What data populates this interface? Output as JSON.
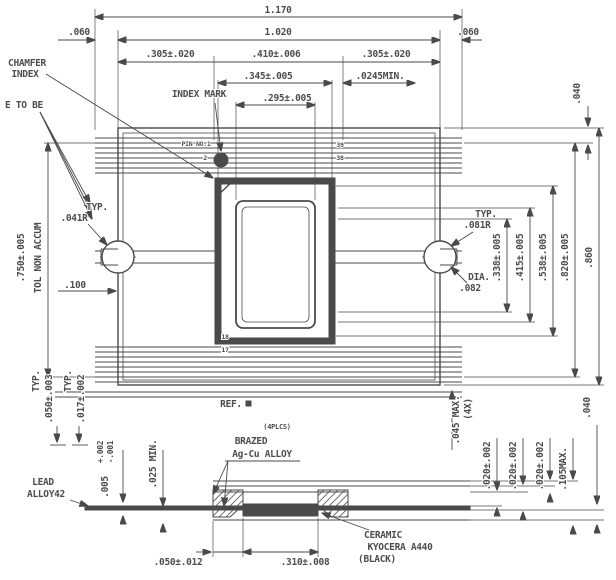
{
  "drawing": {
    "kind": "package outline drawing",
    "colors": {
      "line": "#4a4a4a",
      "ink": "#4d4d4d",
      "background": "#ffffff",
      "ceramic_fill": "#4a4a4a"
    }
  },
  "labels": [
    {
      "name": "dim-overall-width",
      "region": "top-dims",
      "text": "1.170",
      "x": 278,
      "y": 13
    },
    {
      "name": "dim-margin-left",
      "region": "top-dims",
      "text": ".060",
      "x": 79,
      "y": 35
    },
    {
      "name": "dim-body-width",
      "region": "top-dims",
      "text": "1.020",
      "x": 278,
      "y": 35
    },
    {
      "name": "dim-margin-right",
      "region": "top-dims",
      "text": ".060",
      "x": 468,
      "y": 35
    },
    {
      "name": "dim-lead-zone-left",
      "region": "top-dims",
      "text": ".305±.020",
      "x": 170,
      "y": 57
    },
    {
      "name": "dim-center-zone",
      "region": "top-dims",
      "text": ".410±.006",
      "x": 276,
      "y": 57
    },
    {
      "name": "dim-lead-zone-right",
      "region": "top-dims",
      "text": ".305±.020",
      "x": 386,
      "y": 57
    },
    {
      "name": "dim-cavity-outer-width",
      "region": "top-dims",
      "text": ".345±.005",
      "x": 268,
      "y": 79
    },
    {
      "name": "dim-min-clearance",
      "region": "top-dims",
      "text": ".0245MIN.",
      "x": 380,
      "y": 79
    },
    {
      "name": "dim-cavity-inner-width",
      "region": "top-dims",
      "text": ".295±.005",
      "x": 287,
      "y": 101
    },
    {
      "name": "callout-chamfer",
      "region": "left-callouts",
      "text": "CHAMFER",
      "x": 27,
      "y": 66
    },
    {
      "name": "callout-index",
      "region": "left-callouts",
      "text": "INDEX",
      "x": 25,
      "y": 77
    },
    {
      "name": "callout-e-to-be",
      "region": "left-callouts",
      "text": "E TO BE",
      "x": 24,
      "y": 108
    },
    {
      "name": "callout-index-mark",
      "region": "top-view",
      "text": "INDEX MARK",
      "x": 199,
      "y": 97
    },
    {
      "name": "callout-pin-no1",
      "region": "top-view",
      "text": "PIN NO.1",
      "x": 196,
      "y": 146,
      "size": 6.5
    },
    {
      "name": "pin-number-2",
      "region": "top-view",
      "text": "2",
      "x": 205,
      "y": 160,
      "size": 6.5
    },
    {
      "name": "pin-number-39",
      "region": "top-view",
      "text": "39",
      "x": 340,
      "y": 147,
      "size": 6.5
    },
    {
      "name": "pin-number-38",
      "region": "top-view",
      "text": "38",
      "x": 340,
      "y": 160,
      "size": 6.5
    },
    {
      "name": "pin-number-18",
      "region": "top-view",
      "text": "18",
      "x": 225,
      "y": 339,
      "size": 6.5
    },
    {
      "name": "pin-number-17",
      "region": "top-view",
      "text": "17",
      "x": 225,
      "y": 352,
      "size": 6.5
    },
    {
      "name": "typ-left",
      "region": "top-view",
      "text": "TYP.",
      "x": 97,
      "y": 210
    },
    {
      "name": "dim-radius-041",
      "region": "top-view",
      "text": ".041R",
      "x": 74,
      "y": 221
    },
    {
      "name": "dim-100",
      "region": "top-view",
      "text": ".100",
      "x": 75,
      "y": 288
    },
    {
      "name": "typ-right",
      "region": "top-view",
      "text": "TYP.",
      "x": 486,
      "y": 217
    },
    {
      "name": "dim-radius-081",
      "region": "top-view",
      "text": ".081R",
      "x": 477,
      "y": 228
    },
    {
      "name": "label-dia",
      "region": "top-view",
      "text": "DIA.",
      "x": 479,
      "y": 280
    },
    {
      "name": "dim-dia-082",
      "region": "top-view",
      "text": ".082",
      "x": 470,
      "y": 291
    },
    {
      "name": "dim-750",
      "region": "left-dims",
      "text": ".750±.005",
      "x": 24,
      "y": 258,
      "rot": true
    },
    {
      "name": "note-tol-non-accum",
      "region": "left-dims",
      "text": "TOL NON ACCUM",
      "x": 41,
      "y": 258,
      "rot": true
    },
    {
      "name": "dim-338",
      "region": "right-dims",
      "text": ".338±.005",
      "x": 500,
      "y": 258,
      "rot": true
    },
    {
      "name": "dim-415",
      "region": "right-dims",
      "text": ".415±.005",
      "x": 523,
      "y": 258,
      "rot": true
    },
    {
      "name": "dim-538",
      "region": "right-dims",
      "text": ".538±.005",
      "x": 546,
      "y": 258,
      "rot": true
    },
    {
      "name": "dim-820",
      "region": "right-dims",
      "text": ".820±.005",
      "x": 568,
      "y": 258,
      "rot": true
    },
    {
      "name": "dim-860",
      "region": "right-dims",
      "text": ".860",
      "x": 592,
      "y": 258,
      "rot": true
    },
    {
      "name": "dim-040-top",
      "region": "right-dims",
      "text": ".040",
      "x": 580,
      "y": 94,
      "rot": true
    },
    {
      "name": "label-ref",
      "region": "section",
      "text": "REF.",
      "x": 231,
      "y": 407
    },
    {
      "name": "note-4plcs",
      "region": "section",
      "text": "(4PLCS)",
      "x": 277,
      "y": 429,
      "size": 7
    },
    {
      "name": "label-brazed",
      "region": "section",
      "text": "BRAZED",
      "x": 251,
      "y": 444
    },
    {
      "name": "label-agcu-alloy",
      "region": "section",
      "text": "Ag-Cu ALLOY",
      "x": 262,
      "y": 457
    },
    {
      "name": "label-lead",
      "region": "section",
      "text": "LEAD",
      "x": 43,
      "y": 485
    },
    {
      "name": "label-alloy42",
      "region": "section",
      "text": "ALLOY42",
      "x": 46,
      "y": 497
    },
    {
      "name": "label-ceramic",
      "region": "section",
      "text": "CERAMIC",
      "x": 383,
      "y": 538
    },
    {
      "name": "label-kyocera-a440",
      "region": "section",
      "text": "KYOCERA A440",
      "x": 400,
      "y": 550
    },
    {
      "name": "label-black",
      "region": "section",
      "text": "(BLACK)",
      "x": 377,
      "y": 562
    },
    {
      "name": "dim-050-012",
      "region": "section",
      "text": ".050±.012",
      "x": 178,
      "y": 565
    },
    {
      "name": "dim-310-008",
      "region": "section",
      "text": ".310±.008",
      "x": 305,
      "y": 565
    },
    {
      "name": "dim-045-max",
      "region": "section",
      "text": ".045 MAX.",
      "x": 459,
      "y": 420,
      "rot": true
    },
    {
      "name": "qty-4x",
      "region": "section",
      "text": "(4X)",
      "x": 471,
      "y": 409,
      "rot": true
    },
    {
      "name": "typ-bottom-1",
      "region": "section",
      "text": "TYP.",
      "x": 39,
      "y": 381,
      "rot": true
    },
    {
      "name": "dim-050-003",
      "region": "section",
      "text": ".050±.003",
      "x": 52,
      "y": 399,
      "rot": true
    },
    {
      "name": "typ-bottom-2",
      "region": "section",
      "text": "TYP.",
      "x": 71,
      "y": 381,
      "rot": true
    },
    {
      "name": "dim-017-002",
      "region": "section",
      "text": ".017±.002",
      "x": 84,
      "y": 399,
      "rot": true
    },
    {
      "name": "tol-plus-002",
      "region": "section",
      "text": "+.002",
      "x": 103,
      "y": 452,
      "rot": true,
      "size": 8
    },
    {
      "name": "tol-minus-001",
      "region": "section",
      "text": "-.001",
      "x": 113,
      "y": 452,
      "rot": true,
      "size": 8
    },
    {
      "name": "dim-005",
      "region": "section",
      "text": ".005",
      "x": 108,
      "y": 487,
      "rot": true
    },
    {
      "name": "dim-025-min",
      "region": "section",
      "text": ".025 MIN.",
      "x": 156,
      "y": 464,
      "rot": true
    },
    {
      "name": "dim-020-002-a",
      "region": "section",
      "text": ".020±.002",
      "x": 490,
      "y": 466,
      "rot": true
    },
    {
      "name": "dim-020-002-b",
      "region": "section",
      "text": ".020±.002",
      "x": 516,
      "y": 466,
      "rot": true
    },
    {
      "name": "dim-020-002-c",
      "region": "section",
      "text": ".020±.002",
      "x": 543,
      "y": 466,
      "rot": true
    },
    {
      "name": "dim-105-max",
      "region": "section",
      "text": ".105MAX.",
      "x": 566,
      "y": 469,
      "rot": true
    },
    {
      "name": "dim-040-bottom",
      "region": "section",
      "text": ".040",
      "x": 590,
      "y": 408,
      "rot": true
    }
  ]
}
